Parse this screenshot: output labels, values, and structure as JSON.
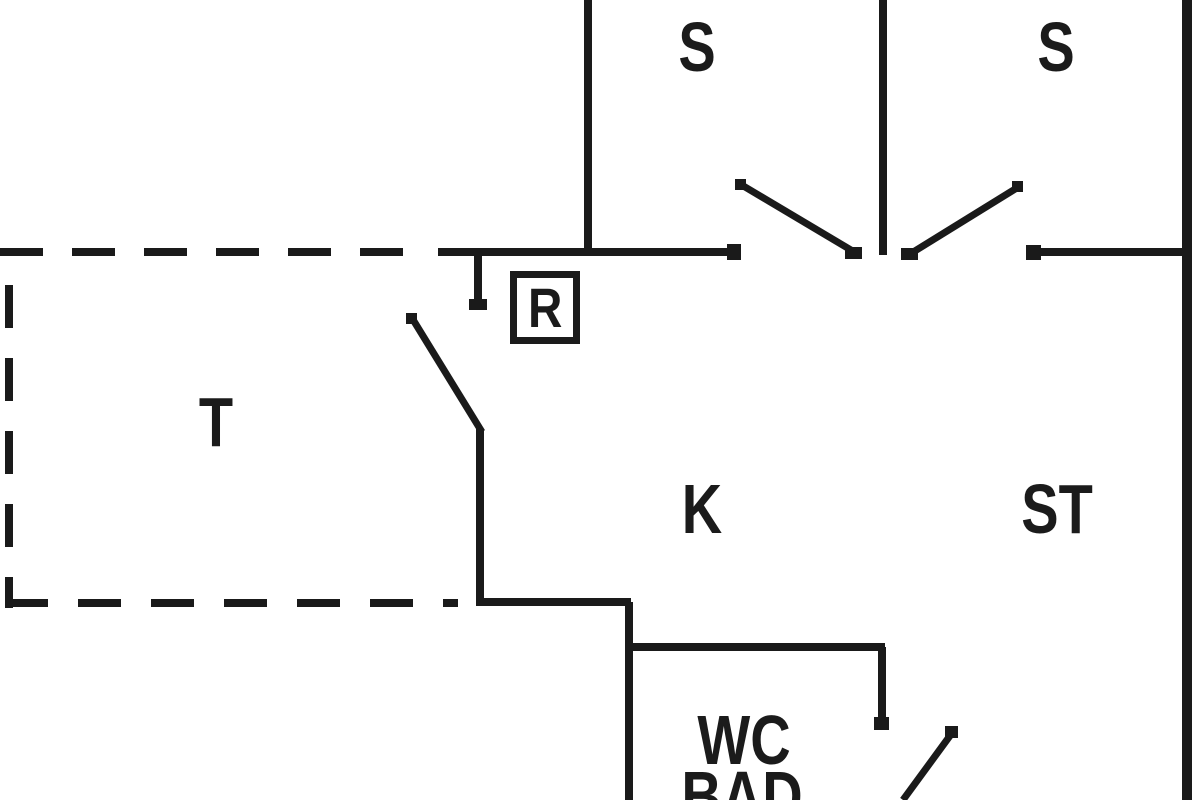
{
  "diagram": {
    "type": "floor-plan",
    "background": "#ffffff",
    "line_color": "#1a1a1a",
    "canvas": {
      "width": 1200,
      "height": 800
    },
    "rooms": [
      {
        "id": "room-s-1",
        "label": "S",
        "cx": 697,
        "cy": 47
      },
      {
        "id": "room-s-2",
        "label": "S",
        "cx": 1056,
        "cy": 47
      },
      {
        "id": "room-t",
        "label": "T",
        "cx": 216,
        "cy": 422
      },
      {
        "id": "room-k",
        "label": "K",
        "cx": 702,
        "cy": 509
      },
      {
        "id": "room-st",
        "label": "ST",
        "cx": 1057,
        "cy": 509
      },
      {
        "id": "room-wc",
        "label": "WC",
        "cx": 744,
        "cy": 740
      },
      {
        "id": "room-bad",
        "label": "BAD",
        "cx": 742,
        "cy": 796
      }
    ],
    "marker": {
      "id": "r-marker",
      "label": "R",
      "x": 510,
      "y": 271,
      "w": 70,
      "h": 73
    },
    "walls": [
      {
        "name": "wall-bedroom-divider-left",
        "x1": 588,
        "y1": 0,
        "x2": 588,
        "y2": 256,
        "w": 8
      },
      {
        "name": "wall-bedroom-divider-mid",
        "x1": 883,
        "y1": 0,
        "x2": 883,
        "y2": 255,
        "w": 8
      },
      {
        "name": "wall-outer-right",
        "x1": 1187,
        "y1": 0,
        "x2": 1187,
        "y2": 800,
        "w": 10
      },
      {
        "name": "wall-hall-top-left",
        "x1": 438,
        "y1": 252,
        "x2": 734,
        "y2": 252,
        "w": 8
      },
      {
        "name": "wall-hall-top-right",
        "x1": 1033,
        "y1": 252,
        "x2": 1192,
        "y2": 252,
        "w": 8
      },
      {
        "name": "door-jamb-hall",
        "x1": 478,
        "y1": 252,
        "x2": 478,
        "y2": 303,
        "w": 8
      },
      {
        "name": "door-leaf-hall",
        "x1": 412,
        "y1": 318,
        "x2": 482,
        "y2": 432,
        "w": 7
      },
      {
        "name": "wall-kitchen-left",
        "x1": 480,
        "y1": 429,
        "x2": 480,
        "y2": 602,
        "w": 8
      },
      {
        "name": "wall-kitchen-bottom",
        "x1": 476,
        "y1": 602,
        "x2": 631,
        "y2": 602,
        "w": 8
      },
      {
        "name": "wall-lower-left",
        "x1": 629,
        "y1": 602,
        "x2": 629,
        "y2": 800,
        "w": 8
      },
      {
        "name": "wall-wc-top",
        "x1": 629,
        "y1": 647,
        "x2": 885,
        "y2": 647,
        "w": 8
      },
      {
        "name": "wall-wc-right",
        "x1": 882,
        "y1": 647,
        "x2": 882,
        "y2": 724,
        "w": 8
      },
      {
        "name": "door-leaf-wc",
        "x1": 952,
        "y1": 733,
        "x2": 903,
        "y2": 800,
        "w": 7
      },
      {
        "name": "door-leaf-double-left",
        "x1": 740,
        "y1": 184,
        "x2": 856,
        "y2": 253,
        "w": 7
      },
      {
        "name": "door-leaf-double-right",
        "x1": 1020,
        "y1": 186,
        "x2": 910,
        "y2": 254,
        "w": 7
      }
    ],
    "caps": [
      {
        "name": "cap-hall-wall-left-end",
        "x": 727,
        "y": 244,
        "w": 14,
        "h": 16
      },
      {
        "name": "cap-hall-wall-right-end",
        "x": 1026,
        "y": 245,
        "w": 15,
        "h": 15
      },
      {
        "name": "cap-double-left-leaf",
        "x": 845,
        "y": 247,
        "w": 17,
        "h": 12
      },
      {
        "name": "cap-double-right-leaf",
        "x": 901,
        "y": 248,
        "w": 17,
        "h": 12
      },
      {
        "name": "cap-door-jamb",
        "x": 469,
        "y": 299,
        "w": 18,
        "h": 11
      },
      {
        "name": "cap-wc-wall-end",
        "x": 874,
        "y": 717,
        "w": 15,
        "h": 13
      },
      {
        "name": "cap-wc-leaf-top",
        "x": 945,
        "y": 726,
        "w": 13,
        "h": 12
      },
      {
        "name": "cap-double-left-leaf-top",
        "x": 735,
        "y": 179,
        "w": 11,
        "h": 11
      },
      {
        "name": "cap-double-right-leaf-top",
        "x": 1012,
        "y": 181,
        "w": 11,
        "h": 11
      },
      {
        "name": "cap-hall-leaf-top",
        "x": 406,
        "y": 313,
        "w": 11,
        "h": 11
      }
    ],
    "dashed_walls": [
      {
        "name": "terrace-outline-top",
        "x1": 0,
        "y1": 252,
        "x2": 415,
        "y2": 252,
        "w": 8,
        "dash": "43 29"
      },
      {
        "name": "terrace-outline-left",
        "x1": 9,
        "y1": 285,
        "x2": 9,
        "y2": 608,
        "w": 8,
        "dash": "43 30"
      },
      {
        "name": "terrace-outline-bottom",
        "x1": 5,
        "y1": 603,
        "x2": 458,
        "y2": 603,
        "w": 8,
        "dash": "43 30"
      }
    ]
  }
}
